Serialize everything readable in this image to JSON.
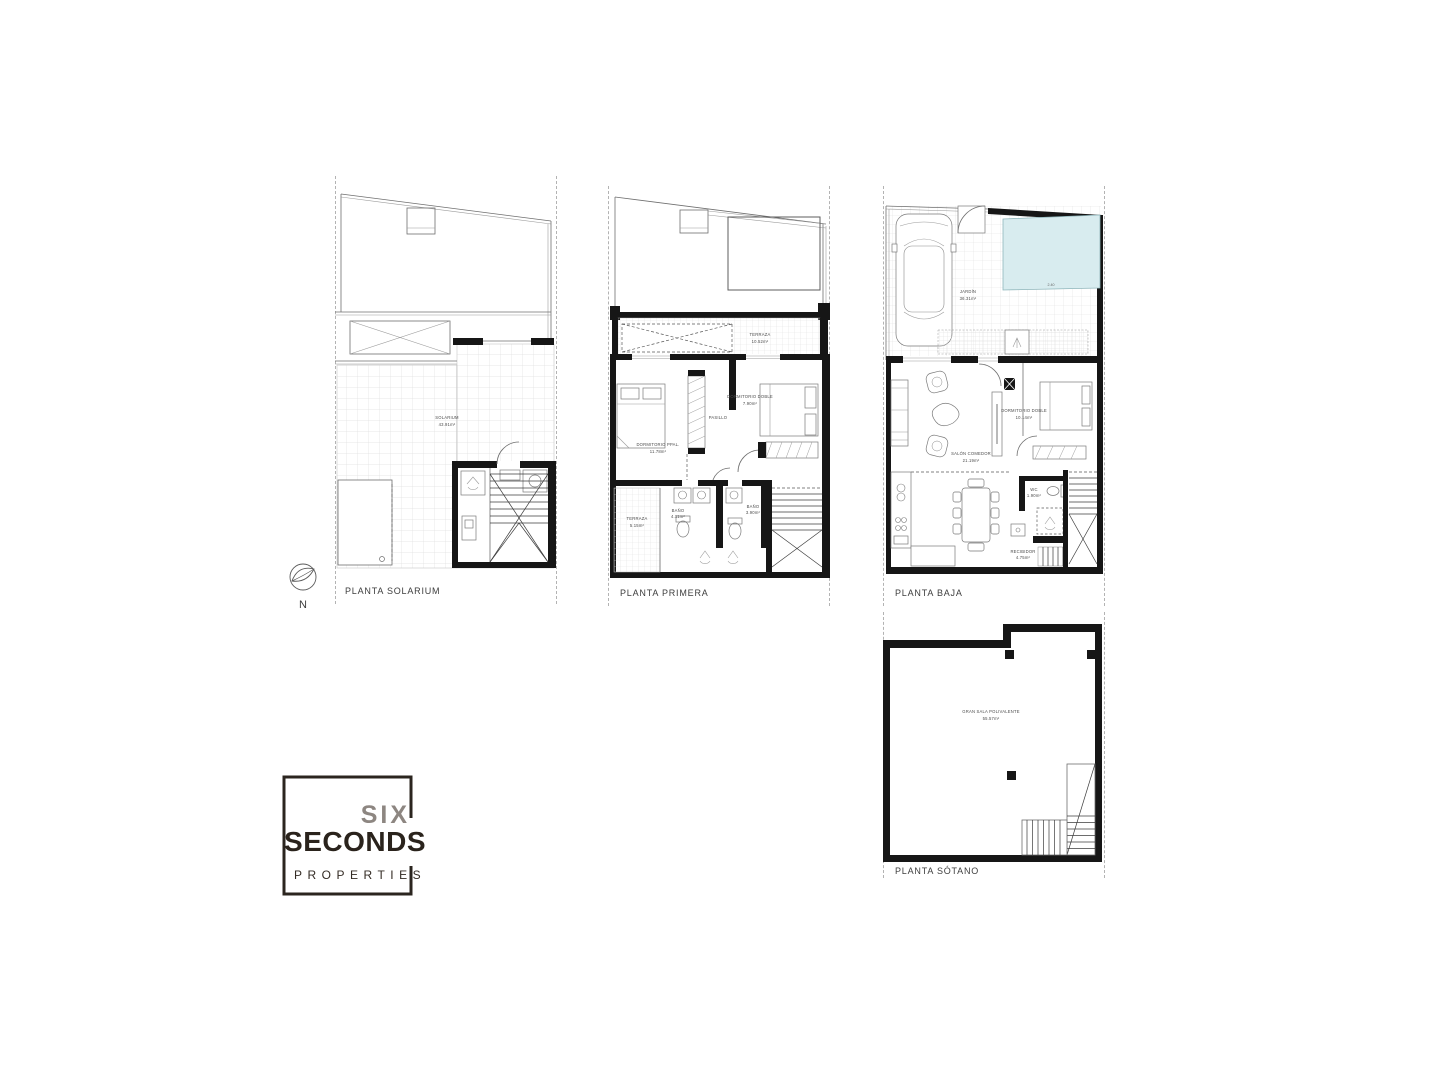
{
  "document": {
    "type": "floor-plan-sheet"
  },
  "colors": {
    "wall": "#161616",
    "line": "#6f6f6f",
    "grid": "#e0e0e0",
    "pool_fill": "#d8ecef",
    "text": "#3d3d3d",
    "logo_gray": "#8d8681",
    "logo_dark": "#2a231c"
  },
  "north": {
    "label": "N"
  },
  "plans": [
    {
      "name": "PLANTA SOLARIUM",
      "rooms": [
        {
          "name": "SOLARIUM",
          "area": "43.91m²"
        }
      ]
    },
    {
      "name": "PLANTA PRIMERA",
      "rooms": [
        {
          "name": "TERRAZA",
          "area": "10.52m²"
        },
        {
          "name": "DORMITORIO PPAL.",
          "area": "11.78m²"
        },
        {
          "name": "DORMITORIO DOBLE",
          "area": "7.90m²"
        },
        {
          "name": "PASILLO",
          "area": ""
        },
        {
          "name": "BAÑO",
          "area": "4.11m²"
        },
        {
          "name": "BAÑO",
          "area": "3.90m²"
        },
        {
          "name": "TERRAZA",
          "area": "5.15m²"
        }
      ]
    },
    {
      "name": "PLANTA BAJA",
      "pool_dimension": "2.40",
      "rooms": [
        {
          "name": "JARDÍN",
          "area": "36.31m²"
        },
        {
          "name": "SALÓN COMEDOR",
          "area": "21.19m²"
        },
        {
          "name": "DORMITORIO DOBLE",
          "area": "10.14m²"
        },
        {
          "name": "WC",
          "area": "1.90m²"
        },
        {
          "name": "RECIBIDOR",
          "area": "4.75m²"
        }
      ]
    },
    {
      "name": "PLANTA SÓTANO",
      "rooms": [
        {
          "name": "GRAN SALA POLIVALENTE",
          "area": "55.57m²"
        }
      ]
    }
  ],
  "logo": {
    "line1": "SIX",
    "line2": "SECONDS",
    "line3": "PROPERTIES"
  }
}
